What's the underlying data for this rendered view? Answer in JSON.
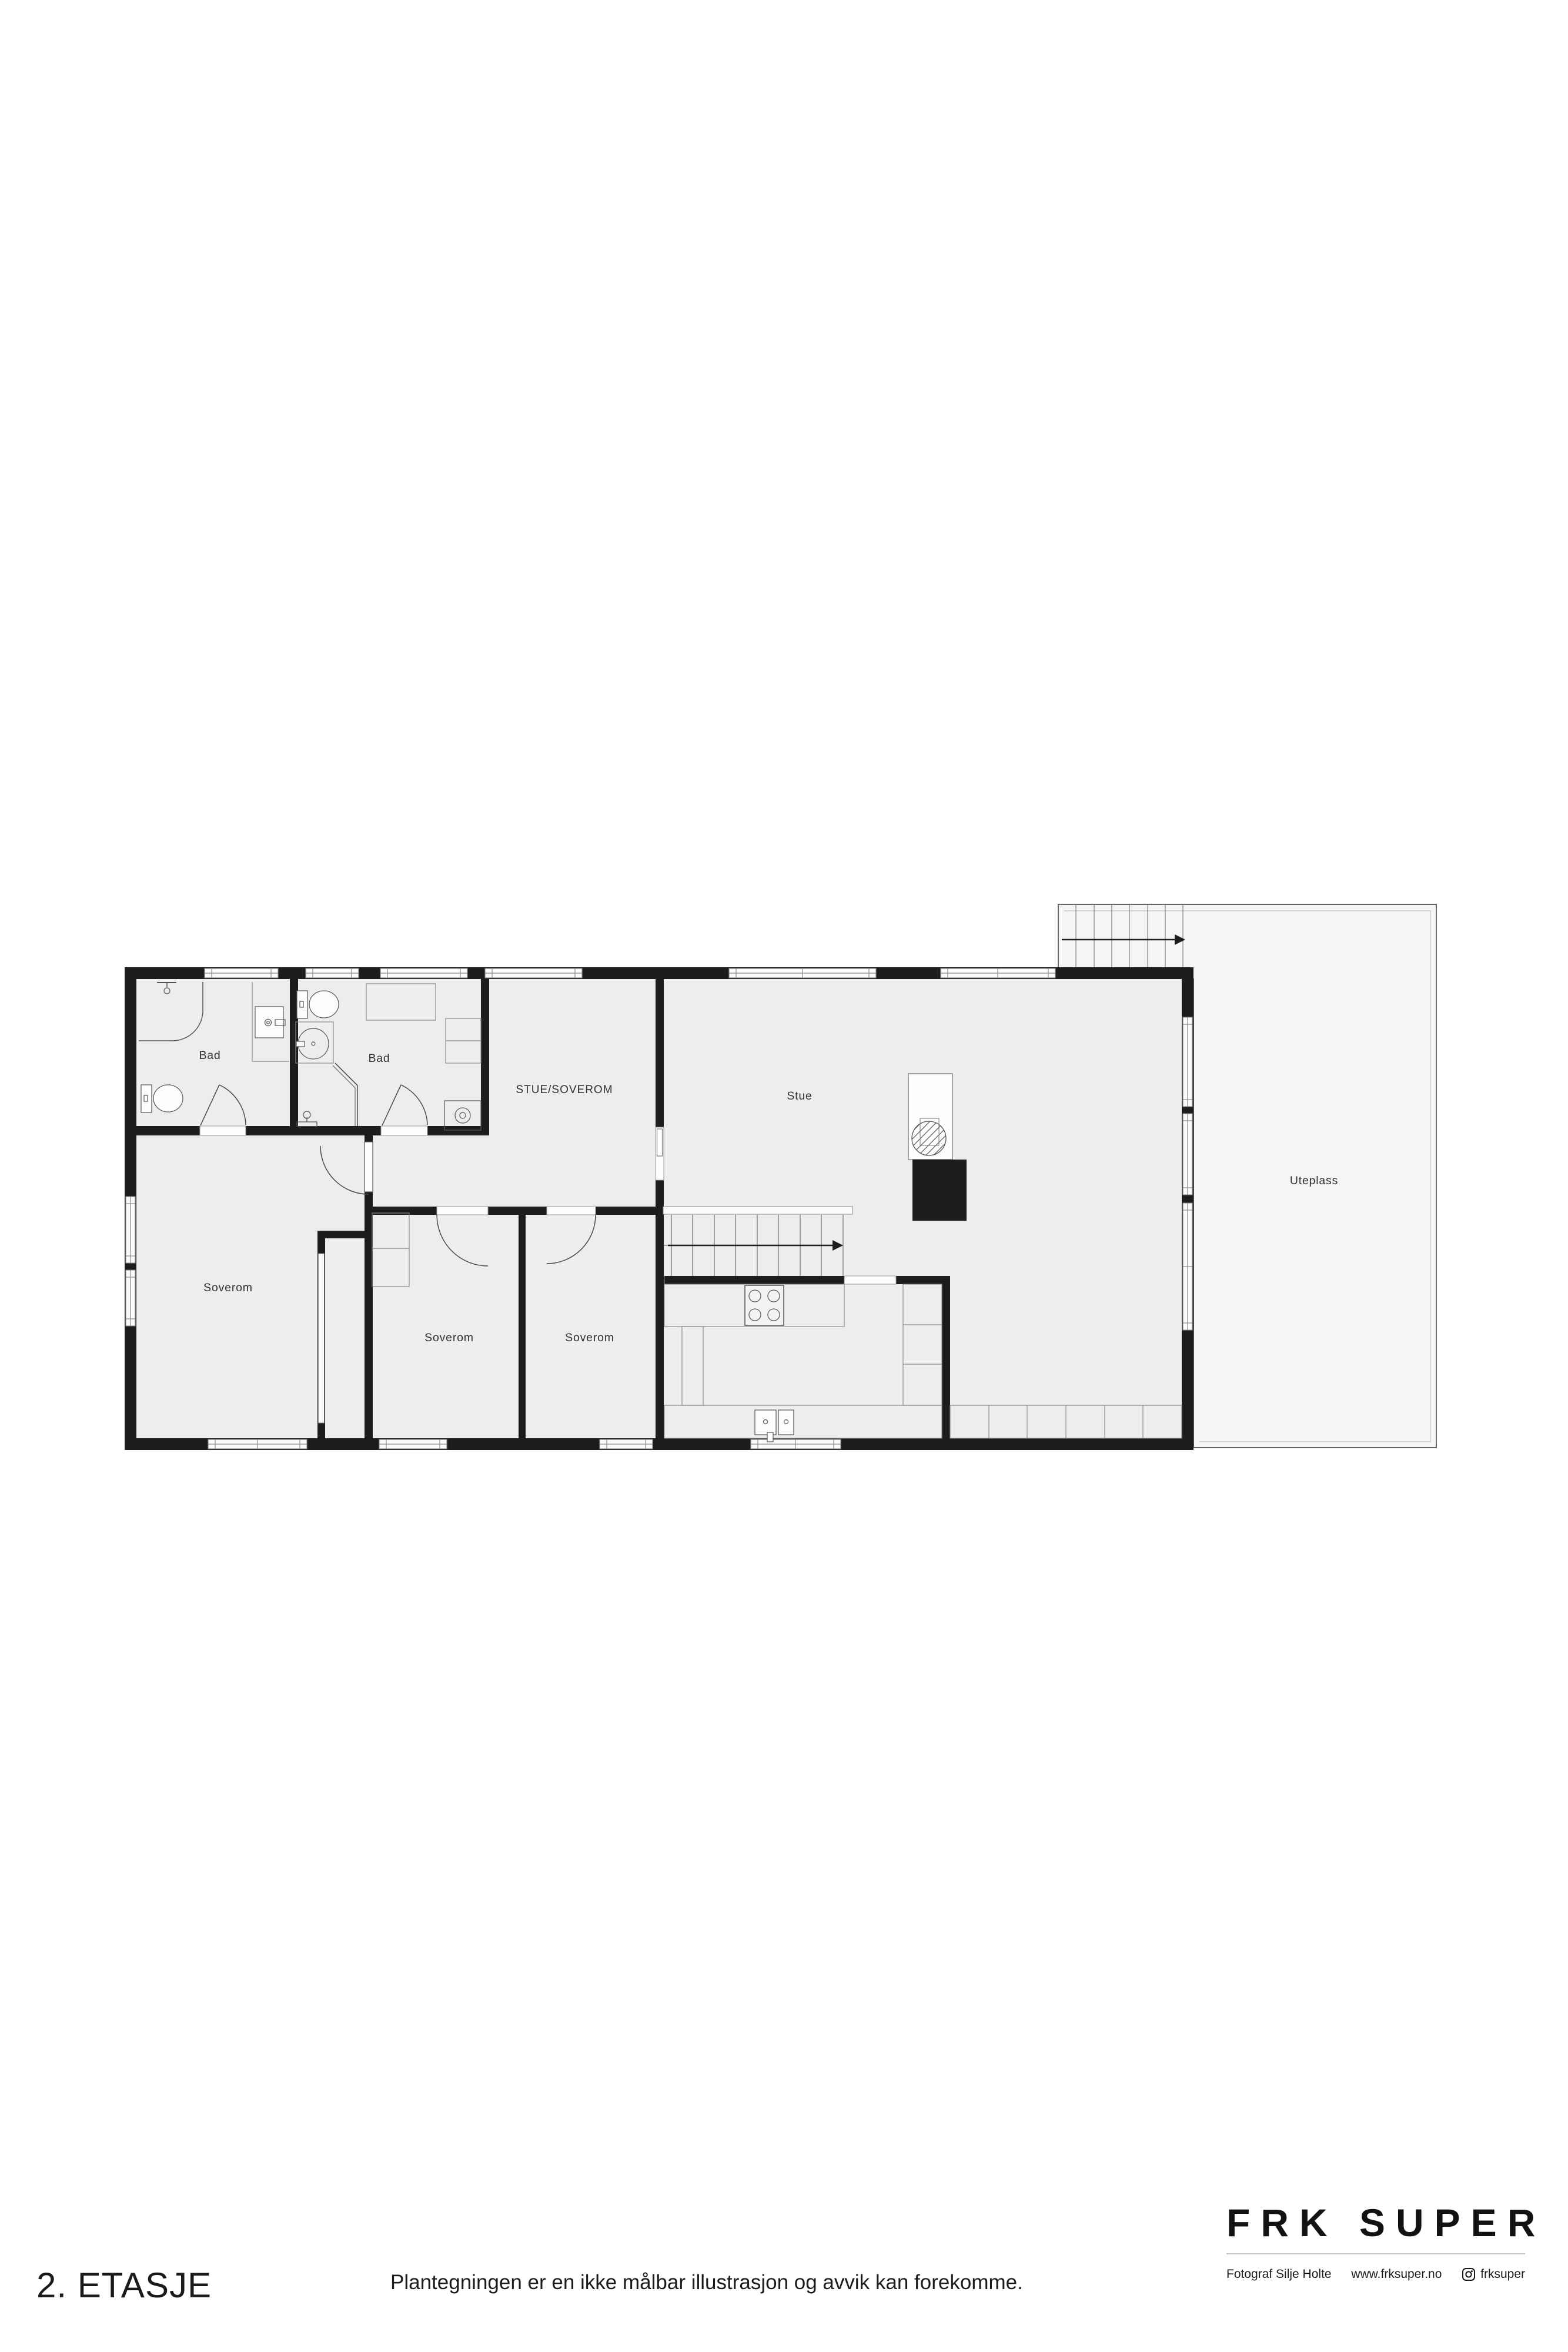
{
  "page": {
    "title": "2. ETASJE",
    "disclaimer": "Plantegningen er en ikke målbar illustrasjon og avvik kan forekomme."
  },
  "branding": {
    "logo": "FRK SUPER",
    "photographer": "Fotograf Silje Holte",
    "website": "www.frksuper.no",
    "instagram": "frksuper"
  },
  "rooms": {
    "bad1": "Bad",
    "bad2": "Bad",
    "stue_soverom": "STUE/SOVEROM",
    "stue": "Stue",
    "uteplass": "Uteplass",
    "soverom1": "Soverom",
    "soverom2": "Soverom",
    "soverom3": "Soverom"
  },
  "plan_features": {
    "stair_direction": "up-right-arrow",
    "fixtures": [
      "shower",
      "toilet",
      "sink",
      "washing-machine",
      "stove",
      "kitchen-sink",
      "fireplace",
      "wardrobe",
      "cabinets"
    ]
  },
  "colors": {
    "wall": "#1d1d20",
    "floor": "#ededee",
    "outdoor": "#f5f5f6",
    "fixture_line": "#55555a",
    "thin_line": "#8a8a8d",
    "label": "#323236",
    "page_bg": "#ffffff"
  }
}
